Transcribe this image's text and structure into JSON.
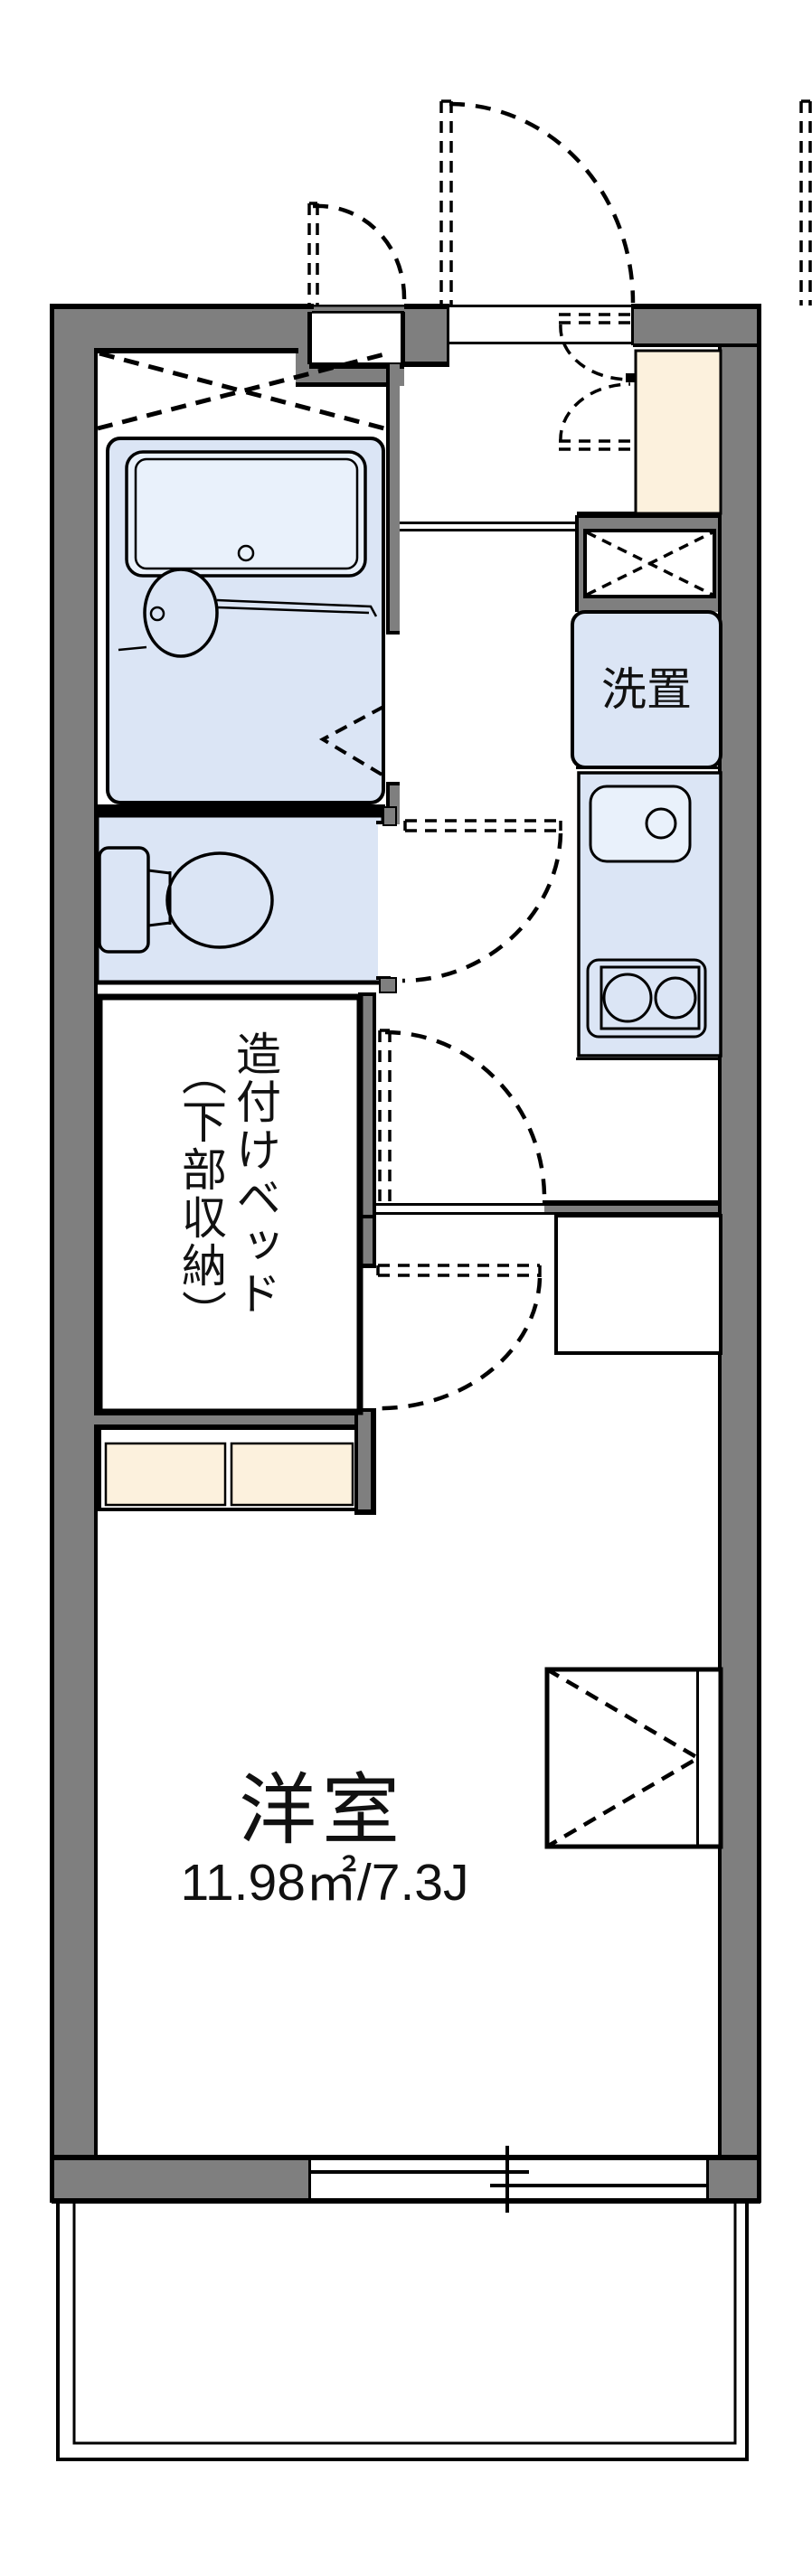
{
  "title": "floor-plan",
  "labels": {
    "laundry": "洗置",
    "bed_line1": "造付けベッド",
    "bed_line2": "（下部収納）",
    "room_name": "洋室",
    "room_area": "11.98㎡/7.3J"
  },
  "colors": {
    "wall": "#7f7f7f",
    "fixture": "#dbe5f5",
    "fixture_light": "#e9f1fb",
    "cabinet": "#fcf1dd",
    "line": "#000000"
  }
}
